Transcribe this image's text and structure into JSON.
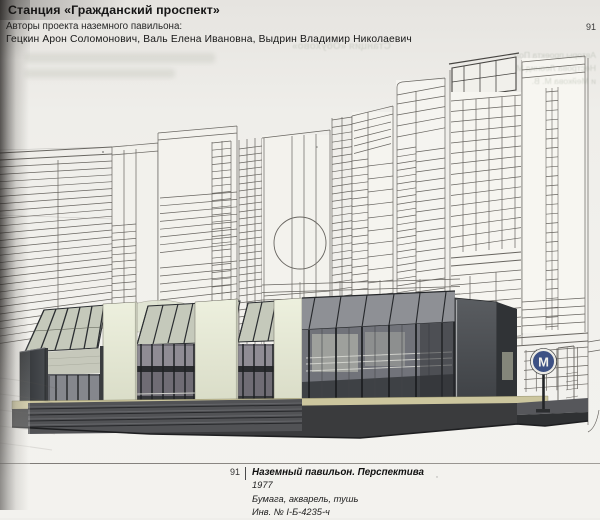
{
  "header": {
    "station_title": "Станция «Гражданский проспект»",
    "authors_label": "Авторы проекта наземного павильона:",
    "authors": "Гецкин Арон Соломонович, Валь Елена Ивановна, Выдрин Владимир Николаевич",
    "page_number": "91"
  },
  "caption": {
    "figure_number": "91",
    "title": "Наземный павильон. Перспектива",
    "year": "1977",
    "medium": "Бумага, акварель, тушь",
    "inventory_number": "Инв. № I-Б-4235-ч"
  },
  "artwork": {
    "metro_sign_letter": "М"
  },
  "bleedthrough": {
    "line1": "Станция «Обухово»",
    "line2": "Авторы проекта Пол",
    "line3": "Нестрова Леонид М",
    "line4": "и Мейкова М. В."
  },
  "colors": {
    "paper": "#efeeea",
    "ink": "#5d5a55",
    "pier": "#e8ebd9",
    "glass": "#71737a",
    "glass_light": "#95929a",
    "wall_dark": "#3f4246",
    "platform": "#3a3b3d",
    "accent_strip": "#ccc69e",
    "metro_blue": "#3d5184",
    "roof_glass": "#c5c9bb",
    "frame_dark": "#26282b"
  }
}
